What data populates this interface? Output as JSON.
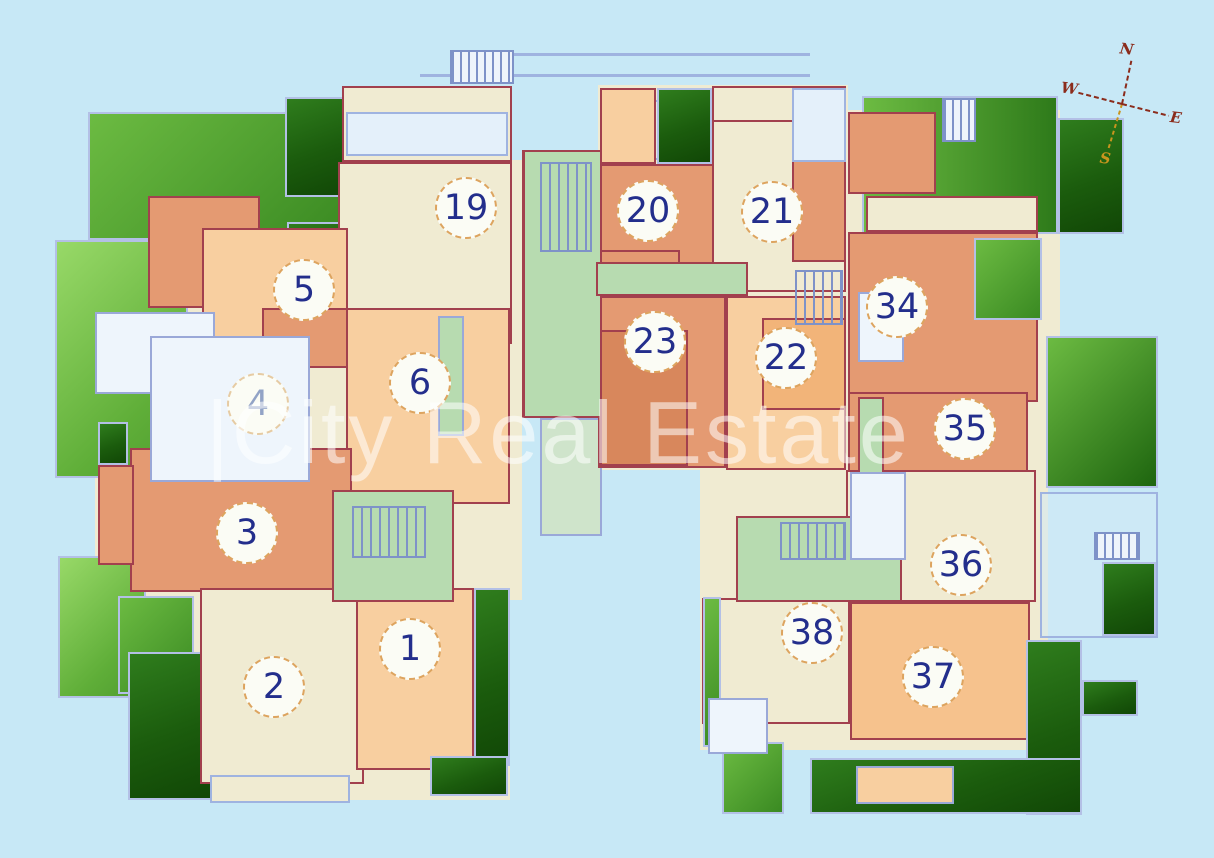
{
  "watermark": "|City Real Estate",
  "compass": {
    "north": "N",
    "west": "W",
    "east": "E",
    "south": "S"
  },
  "units": [
    {
      "id": "19",
      "label": "19"
    },
    {
      "id": "5",
      "label": "5"
    },
    {
      "id": "4",
      "label": "4"
    },
    {
      "id": "6",
      "label": "6"
    },
    {
      "id": "3",
      "label": "3"
    },
    {
      "id": "2",
      "label": "2"
    },
    {
      "id": "1",
      "label": "1"
    },
    {
      "id": "20",
      "label": "20"
    },
    {
      "id": "21",
      "label": "21"
    },
    {
      "id": "23",
      "label": "23"
    },
    {
      "id": "22",
      "label": "22"
    },
    {
      "id": "34",
      "label": "34"
    },
    {
      "id": "35",
      "label": "35"
    },
    {
      "id": "36",
      "label": "36"
    },
    {
      "id": "38",
      "label": "38"
    },
    {
      "id": "37",
      "label": "37"
    }
  ],
  "colors": {
    "background": "#c7e8f6",
    "room_cream": "#f0ebd2",
    "room_peach": "#f8cfa0",
    "room_salmon": "#e49a72",
    "corridor_mint": "#b7dbb0",
    "terrace_green_light": "#6cbb42",
    "terrace_green_dark": "#1b5c0d",
    "wall_red": "#a2404e",
    "outline_blue": "#9fb3e0",
    "unit_number_navy": "#232e8c",
    "circle_border_tan": "#dda45f",
    "compass_red": "#8b2c1c",
    "compass_south_gold": "#c8951e"
  }
}
